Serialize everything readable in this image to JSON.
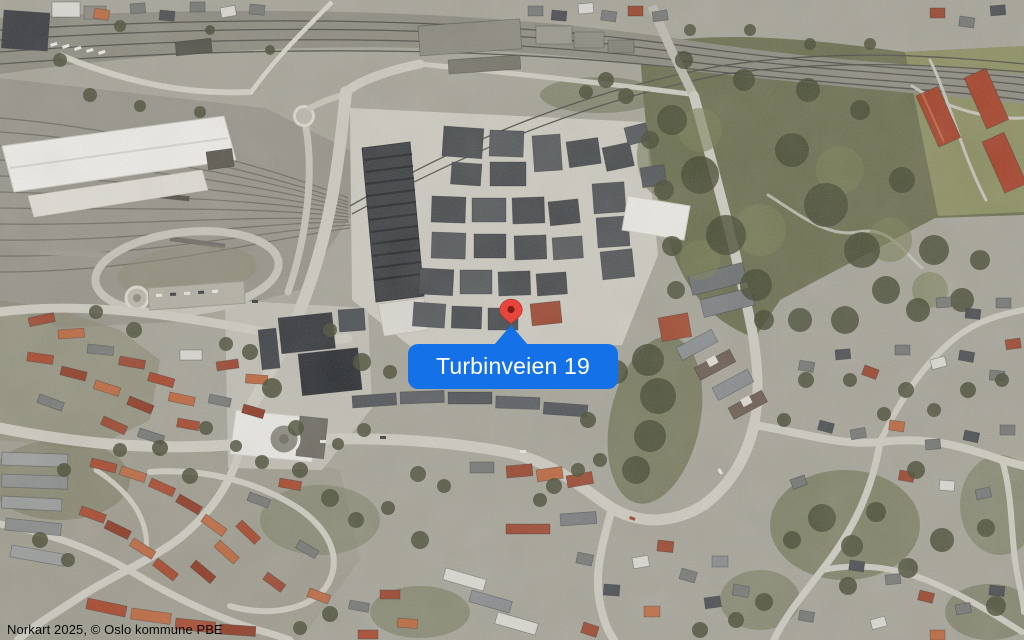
{
  "map": {
    "kind": "aerial-imagery",
    "attribution": "Norkart 2025, © Oslo kommune PBE",
    "marker": {
      "icon": "map-pin-icon",
      "label": "Turbinveien 19",
      "x": 511,
      "y": 309,
      "pin_color": "#e8463c",
      "pin_stroke_color": "#b8352b",
      "pin_core_color": "#7e1d16"
    },
    "callout": {
      "label": "Turbinveien 19",
      "background": "#1571e8",
      "text_color": "#ffffff",
      "x": 408,
      "y": 344,
      "width": 210,
      "height": 45
    }
  }
}
